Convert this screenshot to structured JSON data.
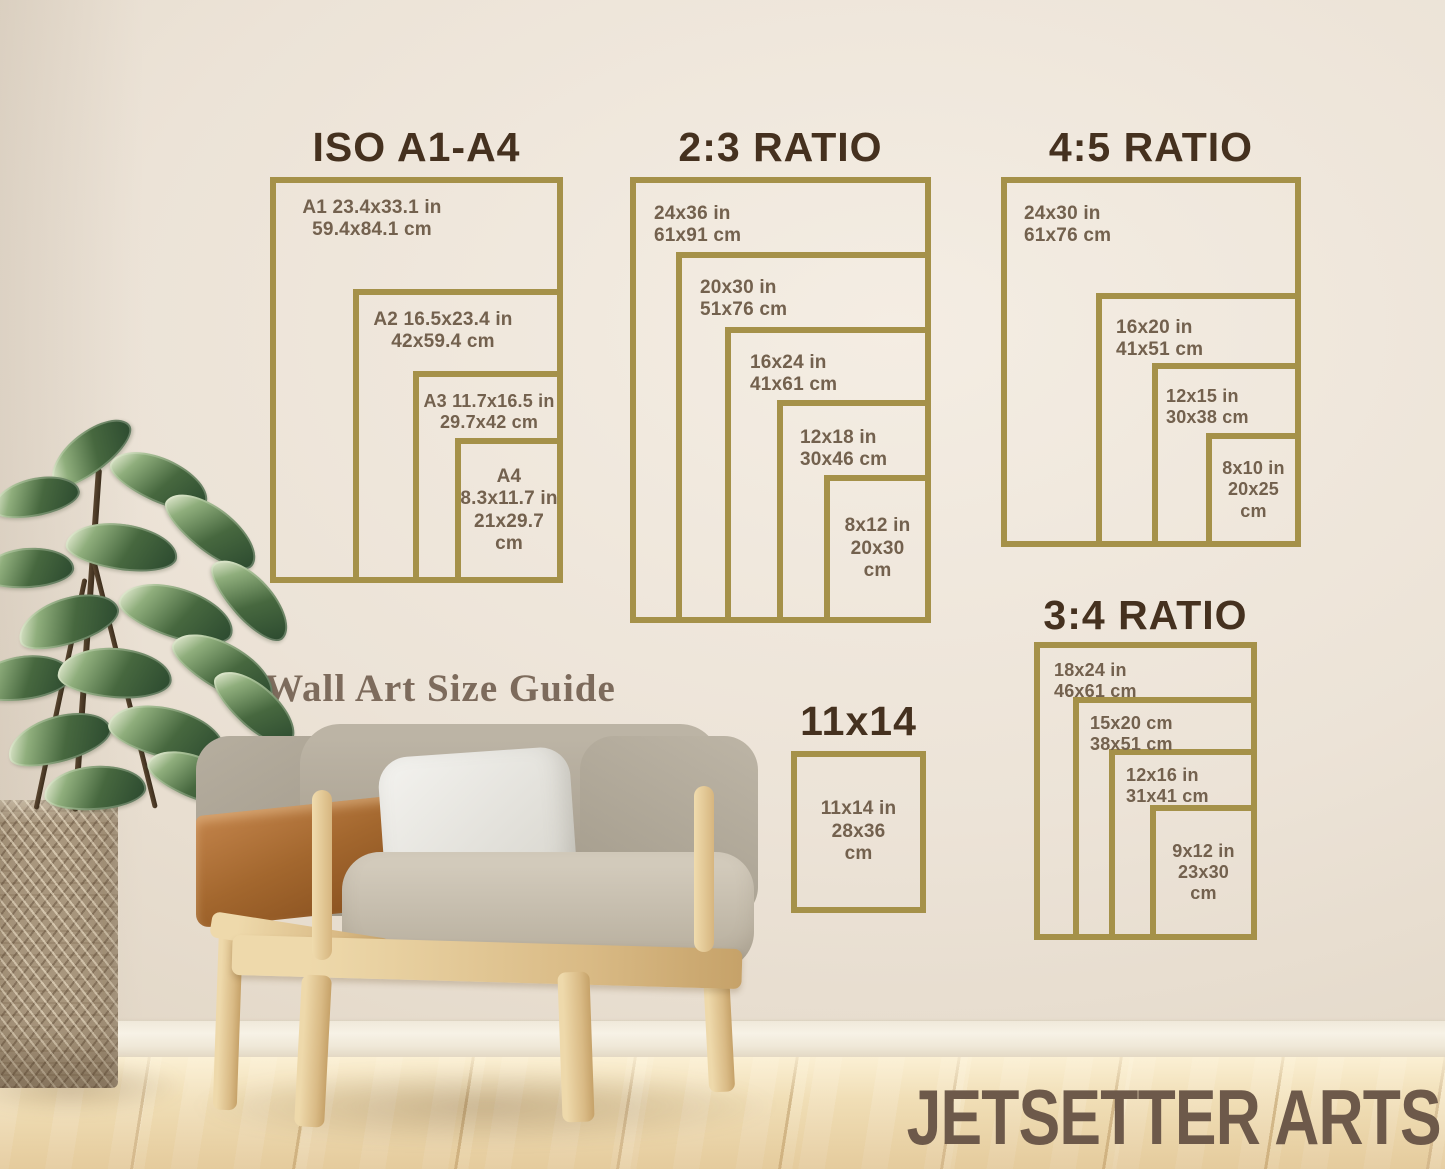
{
  "caption": "Wall Art Size Guide",
  "brand": "JETSETTER ARTS",
  "colors": {
    "frame_gold": "#a59149",
    "title_brown": "#45311f",
    "label_brown": "#73614e",
    "caption_brown": "#7d6b5c",
    "brand_brown": "#6d594a",
    "wall_cream": "#ece3d7",
    "floor_wood": "#efddb5",
    "leather_tan": "#a3672e",
    "plant_green": "#47683f"
  },
  "groups": {
    "iso": {
      "title": "ISO A1-A4",
      "labels": [
        "A1 23.4x33.1 in\n59.4x84.1 cm",
        "A2 16.5x23.4 in\n42x59.4 cm",
        "A3 11.7x16.5 in\n29.7x42 cm",
        "A4\n8.3x11.7 in\n21x29.7\ncm"
      ]
    },
    "ratio23": {
      "title": "2:3 RATIO",
      "labels": [
        "24x36 in\n61x91 cm",
        "20x30 in\n51x76 cm",
        "16x24 in\n41x61 cm",
        "12x18 in\n30x46 cm",
        "8x12 in\n20x30\ncm"
      ]
    },
    "ratio45": {
      "title": "4:5 RATIO",
      "labels": [
        "24x30 in\n61x76 cm",
        "16x20 in\n41x51 cm",
        "12x15 in\n30x38 cm",
        "8x10 in\n20x25\ncm"
      ]
    },
    "ratio34": {
      "title": "3:4 RATIO",
      "labels": [
        "18x24 in\n46x61 cm",
        "15x20 cm\n38x51 cm",
        "12x16 in\n31x41 cm",
        "9x12 in\n23x30\ncm"
      ]
    },
    "size1114": {
      "title": "11x14",
      "labels": [
        "11x14 in\n28x36\ncm"
      ]
    }
  }
}
